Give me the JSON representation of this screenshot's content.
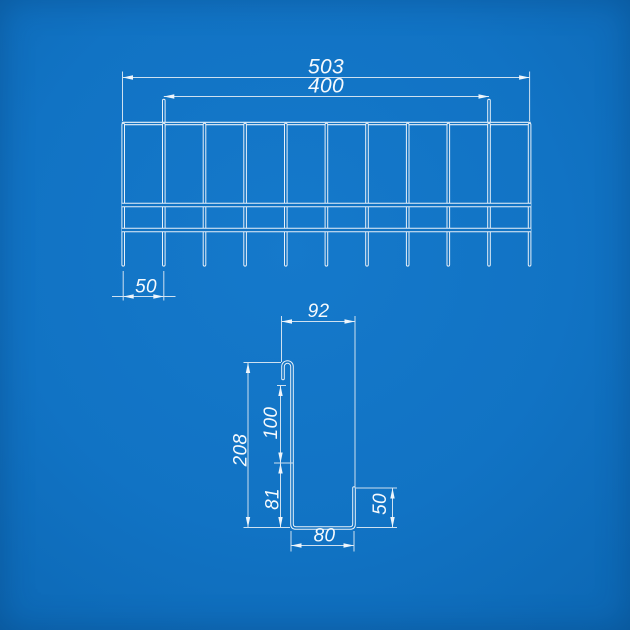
{
  "drawing": {
    "front_view": {
      "dim_overall_width": "503",
      "dim_hook_spacing": "400",
      "dim_wire_pitch": "50"
    },
    "profile_view": {
      "dim_top_depth": "92",
      "dim_total_height": "208",
      "dim_upper_height": "100",
      "dim_lower_height": "81",
      "dim_lip_height": "50",
      "dim_base_width": "80"
    },
    "colors": {
      "background": "#1173c4",
      "line": "#e8f1f9",
      "dimension": "#cfe1f0",
      "label": "#f6fafd"
    }
  }
}
